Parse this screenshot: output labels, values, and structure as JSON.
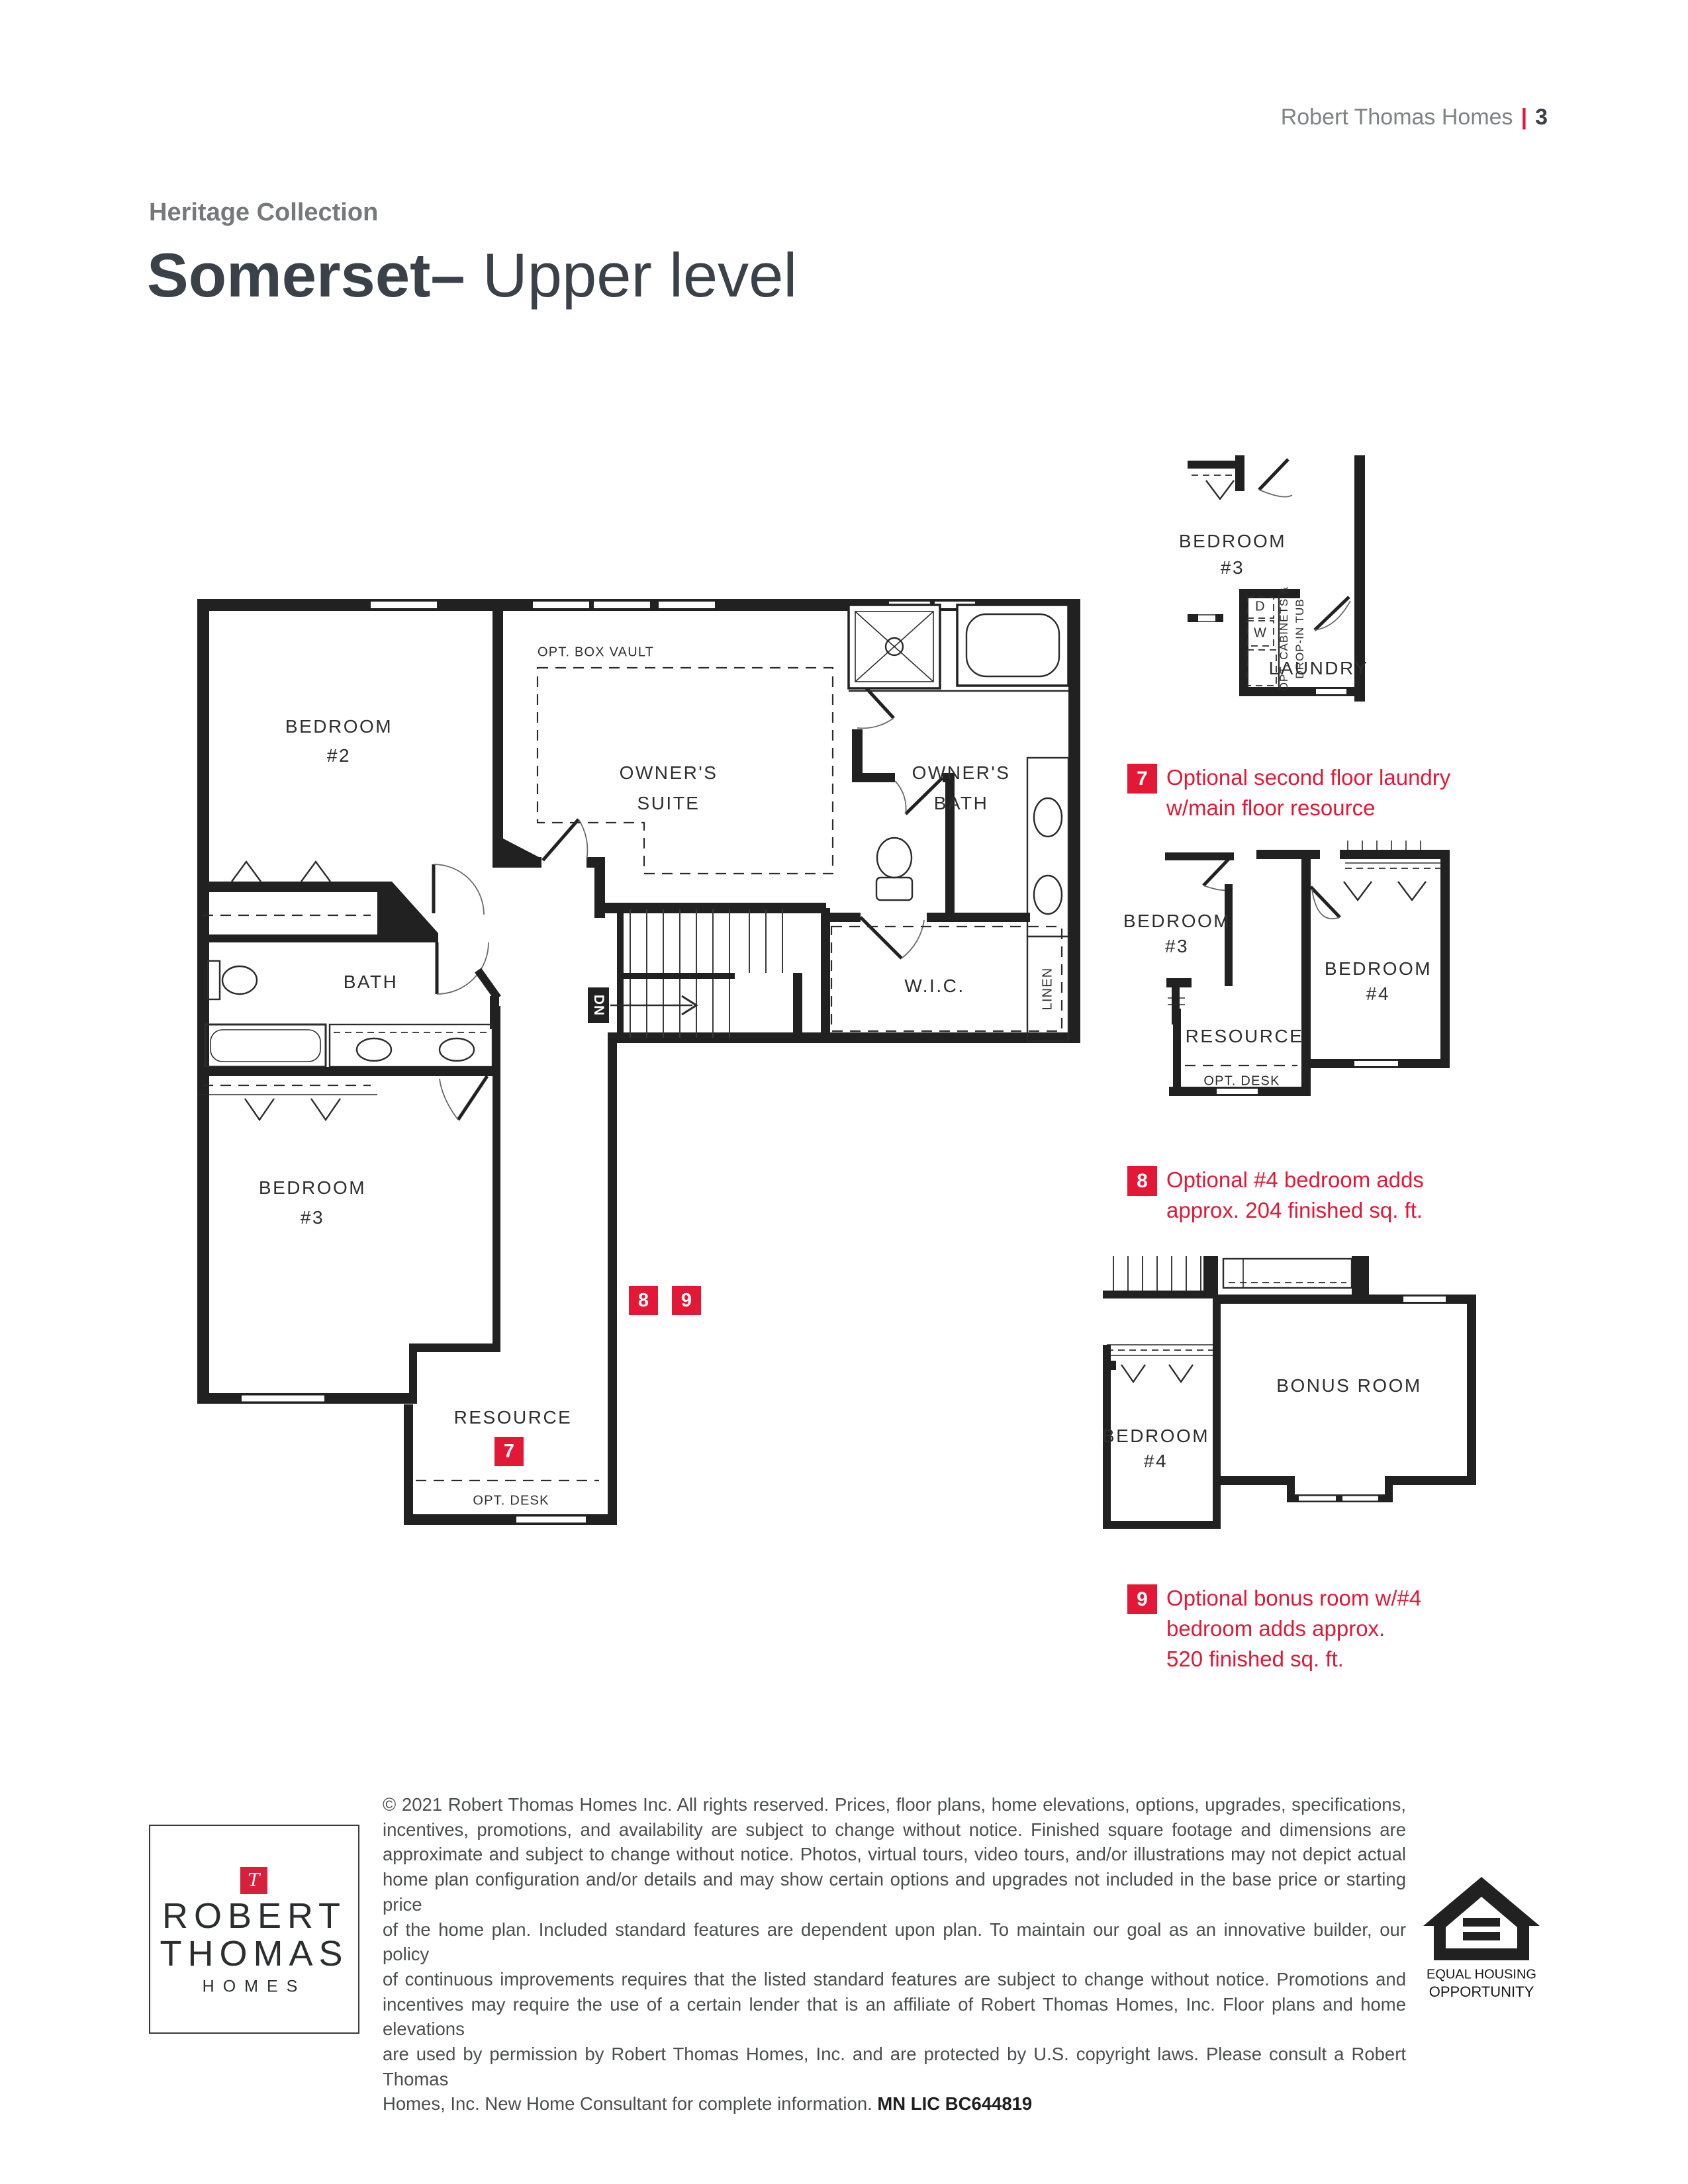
{
  "header": {
    "brand": "Robert Thomas Homes",
    "divider": "|",
    "page_number": "3"
  },
  "title": {
    "collection": "Heritage Collection",
    "model": "Somerset",
    "dash": "–",
    "level": " Upper level"
  },
  "colors": {
    "accent_red": "#e31837",
    "wall_ink": "#212121",
    "title_ink": "#3a4149",
    "collection_gray": "#77787b"
  },
  "plan": {
    "bedroom2_l1": "BEDROOM",
    "bedroom2_l2": "#2",
    "suite_l1": "OWNER'S",
    "suite_l2": "SUITE",
    "opt_box_vault": "OPT. BOX VAULT",
    "owners_bath_l1": "OWNER'S",
    "owners_bath_l2": "BATH",
    "bath": "BATH",
    "wic": "W.I.C.",
    "linen": "LINEN",
    "dn": "DN",
    "bedroom3_l1": "BEDROOM",
    "bedroom3_l2": "#3",
    "resource": "RESOURCE",
    "opt_desk": "OPT. DESK",
    "marker7": "7",
    "marker8": "8",
    "marker9": "9"
  },
  "inset_laundry": {
    "bedroom3_l1": "BEDROOM",
    "bedroom3_l2": "#3",
    "dryer": "D",
    "washer": "W",
    "opt_cab_l1": "OPT. CABINETS &",
    "opt_cab_l2": "DROP-IN TUB",
    "laundry": "LAUNDRY"
  },
  "callout7": {
    "num": "7",
    "line1": "Optional second floor laundry",
    "line2": "w/main floor resource"
  },
  "inset_bed4": {
    "bedroom3_l1": "BEDROOM",
    "bedroom3_l2": "#3",
    "bedroom4_l1": "BEDROOM",
    "bedroom4_l2": "#4",
    "resource": "RESOURCE",
    "opt_desk": "OPT. DESK"
  },
  "callout8": {
    "num": "8",
    "line1": "Optional #4 bedroom adds",
    "line2": "approx. 204 finished sq. ft."
  },
  "inset_bonus": {
    "bonus": "BONUS ROOM",
    "bedroom4_l1": "BEDROOM",
    "bedroom4_l2": "#4"
  },
  "callout9": {
    "num": "9",
    "line1": "Optional bonus room w/#4",
    "line2": "bedroom adds approx.",
    "line3": "520 finished sq. ft."
  },
  "logo": {
    "t": "T",
    "line1": "ROBERT",
    "line2": "THOMAS",
    "line3": "HOMES"
  },
  "eho": {
    "line1": "EQUAL HOUSING",
    "line2": "OPPORTUNITY"
  },
  "footer": {
    "lines": [
      "© 2021 Robert Thomas Homes Inc. All rights reserved. Prices, floor plans, home elevations, options, upgrades, specifications,",
      "incentives, promotions, and availability are subject to change without notice. Finished square footage and dimensions are",
      "approximate and subject to change without notice. Photos, virtual tours, video tours, and/or illustrations may not depict actual",
      "home plan configuration and/or details and may show certain options and upgrades not included in the base price or starting price",
      "of the home plan. Included standard features are dependent upon plan. To maintain our goal as an innovative builder, our policy",
      "of continuous improvements requires that the listed standard features are subject to change without notice. Promotions and",
      "incentives may require the use of a certain lender that is an affiliate of Robert Thomas Homes, Inc. Floor plans and home elevations",
      "are used by permission by Robert Thomas Homes, Inc. and are protected by U.S. copyright laws. Please consult a Robert Thomas"
    ],
    "last_line_prefix": "Homes, Inc. New Home Consultant for complete information. ",
    "license": "MN LIC BC644819"
  }
}
